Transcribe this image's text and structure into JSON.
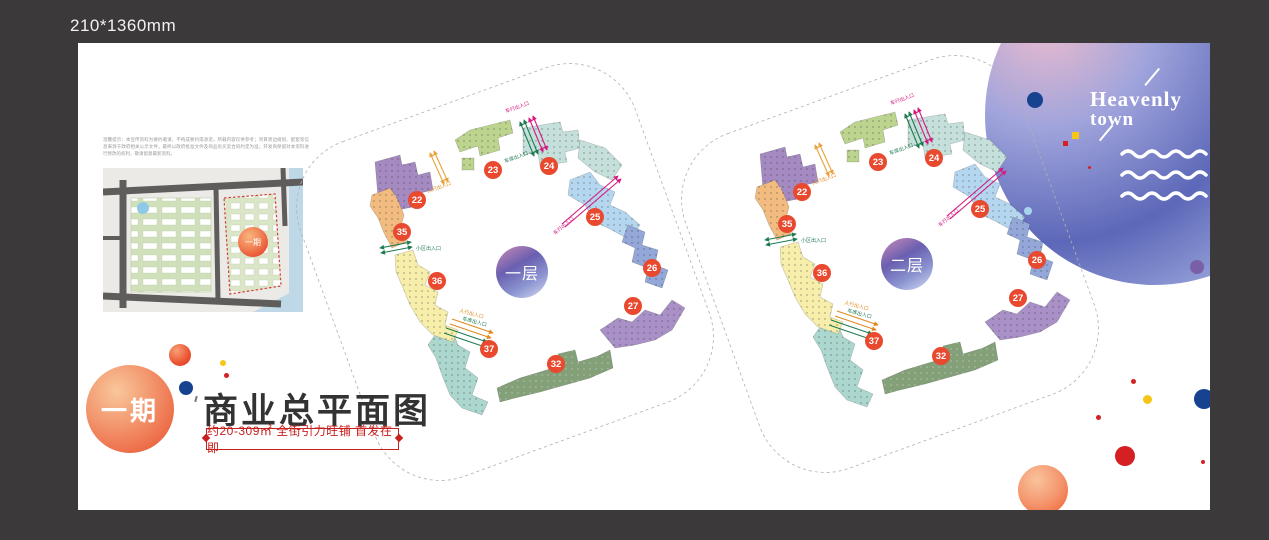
{
  "canvas": {
    "size_label": "210*1360mm"
  },
  "brand": {
    "line1": "Heavenly",
    "line2": "town"
  },
  "disclaimer": "温馨提示：本宣传资料为要约邀请，不构成要约或承诺，所载内容仅供参考；项目周边规划、配套等信息来源于政府相关公示文件，最终以政府批准文件及商品房买卖合同约定为准；开发商保留对本资料进行修改的权利，敬请留意最新资料。",
  "minimap": {
    "phase_badge": "一期"
  },
  "title_block": {
    "phase": "一期",
    "title": "商业总平面图",
    "subtitle": "约20-309㎡ 全街引力旺铺 首发在即"
  },
  "labels": {
    "pedestrian": "人行出入口",
    "vehicle": "车行出入口",
    "garage": "车库出入口",
    "community": "小区出入口"
  },
  "plans": [
    {
      "floor": "一层",
      "units": [
        "22",
        "23",
        "24",
        "25",
        "26",
        "27",
        "32",
        "35",
        "36",
        "37"
      ]
    },
    {
      "floor": "二层",
      "units": [
        "22",
        "23",
        "24",
        "25",
        "26",
        "27",
        "32",
        "35",
        "36",
        "37"
      ]
    }
  ]
}
